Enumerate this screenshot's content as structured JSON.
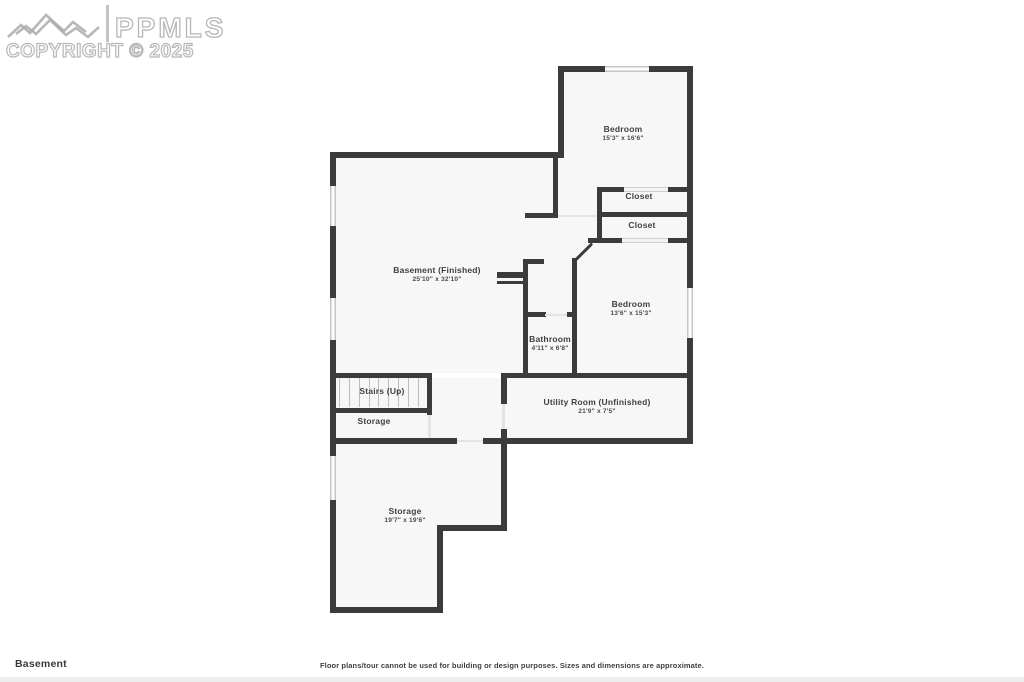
{
  "watermark": {
    "logo_text": "PPMLS",
    "copyright": "COPYRIGHT © 2025"
  },
  "floor_label": "Basement",
  "disclaimer": "Floor plans/tour cannot be used for building or design purposes. Sizes and dimensions are approximate.",
  "rooms": [
    {
      "name": "Bedroom",
      "dims": "15'3\" x 16'6\""
    },
    {
      "name": "Closet",
      "dims": ""
    },
    {
      "name": "Closet",
      "dims": ""
    },
    {
      "name": "Basement (Finished)",
      "dims": "25'10\" x 32'10\""
    },
    {
      "name": "Bedroom",
      "dims": "13'6\" x 15'3\""
    },
    {
      "name": "Bathroom",
      "dims": "4'11\" x 6'8\""
    },
    {
      "name": "Stairs (Up)",
      "dims": ""
    },
    {
      "name": "Storage",
      "dims": ""
    },
    {
      "name": "Utility Room (Unfinished)",
      "dims": "21'9\" x 7'5\""
    },
    {
      "name": "Storage",
      "dims": "19'7\" x 19'6\""
    }
  ],
  "colors": {
    "wall": "#3b3b3b",
    "floor": "#f7f7f7",
    "window": "#c6c6c6",
    "label": "#3f3f3f"
  }
}
